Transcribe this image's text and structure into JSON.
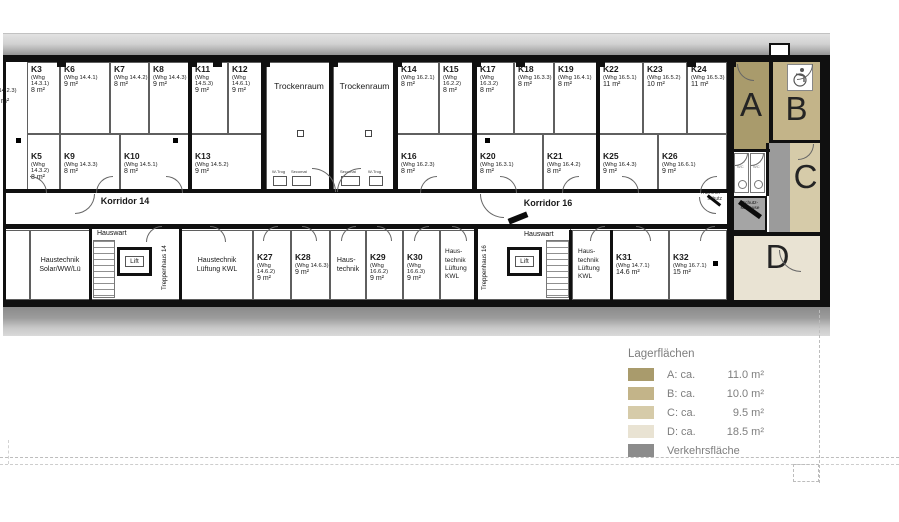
{
  "corridors": {
    "korridor14": "Korridor 14",
    "korridor16": "Korridor 16"
  },
  "top_rooms": [
    {
      "id": "K3",
      "whg": "(Whg 14.3.1)",
      "area": "8 m²"
    },
    {
      "id": "K6",
      "whg": "(Whg 14.4.1)",
      "area": "9 m²"
    },
    {
      "id": "K7",
      "whg": "(Whg 14.4.2)",
      "area": "8 m²"
    },
    {
      "id": "K8",
      "whg": "(Whg 14.4.3)",
      "area": "9 m²"
    },
    {
      "id": "K11",
      "whg": "(Whg 14.5.3)",
      "area": "9 m²"
    },
    {
      "id": "K12",
      "whg": "(Whg 14.6.1)",
      "area": "9 m²"
    },
    {
      "id": "K14",
      "whg": "(Whg 16.2.1)",
      "area": "8 m²"
    },
    {
      "id": "K15",
      "whg": "(Whg 16.2.2)",
      "area": "8 m²"
    },
    {
      "id": "K17",
      "whg": "(Whg 16.3.2)",
      "area": "8 m²"
    },
    {
      "id": "K18",
      "whg": "(Whg 16.3.3)",
      "area": "8 m²"
    },
    {
      "id": "K19",
      "whg": "(Whg 16.4.1)",
      "area": "8 m²"
    },
    {
      "id": "K22",
      "whg": "(Whg 16.5.1)",
      "area": "11 m²"
    },
    {
      "id": "K23",
      "whg": "(Whg 16.5.2)",
      "area": "10 m²"
    },
    {
      "id": "K24",
      "whg": "(Whg 16.5.3)",
      "area": "11 m²"
    }
  ],
  "lower_rooms": [
    {
      "id": "K5",
      "whg": "(Whg 14.3.2)",
      "area": "8 m²"
    },
    {
      "id": "K9",
      "whg": "(Whg 14.3.3)",
      "area": "8 m²"
    },
    {
      "id": "K10",
      "whg": "(Whg 14.5.1)",
      "area": "8 m²"
    },
    {
      "id": "K13",
      "whg": "(Whg 14.5.2)",
      "area": "9 m²"
    },
    {
      "id": "K16",
      "whg": "(Whg 16.2.3)",
      "area": "8 m²"
    },
    {
      "id": "K20",
      "whg": "(Whg 16.3.1)",
      "area": "8 m²"
    },
    {
      "id": "K21",
      "whg": "(Whg 16.4.2)",
      "area": "8 m²"
    },
    {
      "id": "K25",
      "whg": "(Whg 16.4.3)",
      "area": "9 m²"
    },
    {
      "id": "K26",
      "whg": "(Whg 16.6.1)",
      "area": "9 m²"
    }
  ],
  "bottom_rooms": [
    {
      "id": "K27",
      "whg": "(Whg 14.6.2)",
      "area": "9 m²"
    },
    {
      "id": "K28",
      "whg": "(Whg 14.6.3)",
      "area": "9 m²"
    },
    {
      "id": "K29",
      "whg": "(Whg 16.6.2)",
      "area": "9 m²"
    },
    {
      "id": "K30",
      "whg": "(Whg 16.6.3)",
      "area": "9 m²"
    },
    {
      "id": "K31",
      "whg": "(Whg 14.7.1)",
      "area": "14.6 m²"
    },
    {
      "id": "K32",
      "whg": "(Whg 16.7.1)",
      "area": "15 m²"
    }
  ],
  "partial_room": {
    "whg": "(Whg 14.2.3)",
    "area": "m²"
  },
  "trockenraum": {
    "label": "Trockenraum",
    "w_trog": "W-Trog",
    "secomat": "Secomat"
  },
  "service": {
    "haustechnik_solar": "Haustechnik\nSolar/WW/Lü",
    "haustechnik_kwl_wide": "Haustechnik\nLüftung KWL",
    "haustechnik_short": "Haus-\ntechnik",
    "haustechnik_kwl_narrow": "Haus-\ntechnik\nLüftung\nKWL",
    "hauswart": "Hauswart",
    "lift": "Lift",
    "treppenhaus14": "Treppenhaus 14",
    "treppenhaus16": "Treppenhaus 16",
    "wc": "WC"
  },
  "annotations": {
    "truemmerschutz": "Trümmer-\nschutz",
    "schutzschleuse": "Schutz-\nschleuse"
  },
  "storage_letters": {
    "a": "A",
    "b": "B",
    "c": "C",
    "d": "D"
  },
  "legend": {
    "title": "Lagerflächen",
    "items": [
      {
        "key": "A",
        "label": "A: ca.",
        "value": "11.0 m²",
        "color": "#a99b6c"
      },
      {
        "key": "B",
        "label": "B: ca.",
        "value": "10.0 m²",
        "color": "#c3b489"
      },
      {
        "key": "C",
        "label": "C: ca.",
        "value": "9.5 m²",
        "color": "#d6cba9"
      },
      {
        "key": "D",
        "label": "D: ca.",
        "value": "18.5 m²",
        "color": "#e9e3d3"
      },
      {
        "key": "V",
        "label": "Verkehrsfläche",
        "value": "",
        "color": "#8c8c8c"
      }
    ]
  }
}
